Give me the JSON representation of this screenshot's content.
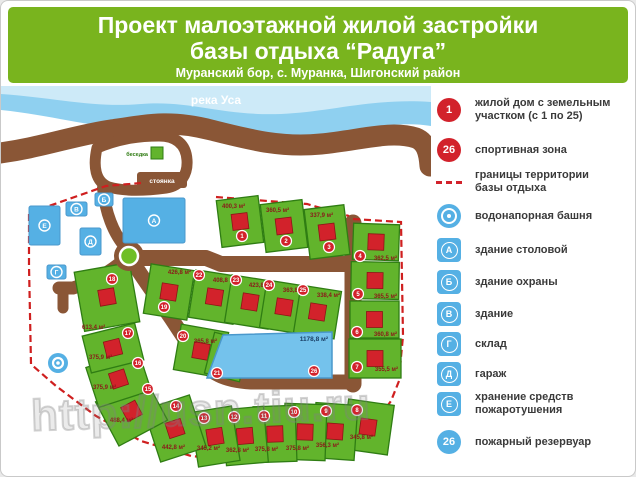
{
  "header": {
    "title_line1": "Проект малоэтажной жилой застройки",
    "title_line2": "базы отдыха “Радуга”",
    "subtitle": "Муранский бор, с. Муранка, Шигонский район"
  },
  "map": {
    "labels": {
      "river": "река Уса",
      "parking": "стоянка",
      "gazebo": "беседка"
    },
    "pond": {
      "area": "1178,8 м²",
      "badge": "26"
    },
    "plots": [
      {
        "n": "1",
        "area": "400,3 м²",
        "x": 218,
        "y": 112,
        "w": 42,
        "h": 47,
        "rot": -7,
        "bx": 241,
        "by": 150,
        "lx": 221,
        "ly": 122,
        "la": "start"
      },
      {
        "n": "2",
        "area": "360,5 м²",
        "x": 262,
        "y": 116,
        "w": 42,
        "h": 48,
        "rot": -7,
        "bx": 285,
        "by": 155,
        "lx": 265,
        "ly": 126,
        "la": "start"
      },
      {
        "n": "3",
        "area": "337,9 м²",
        "x": 306,
        "y": 121,
        "w": 40,
        "h": 50,
        "rot": -7,
        "bx": 328,
        "by": 161,
        "lx": 309,
        "ly": 131,
        "la": "start"
      },
      {
        "n": "4",
        "area": "362,5 м²",
        "x": 352,
        "y": 138,
        "w": 46,
        "h": 36,
        "rot": 2,
        "bx": 359,
        "by": 170,
        "lx": 396,
        "ly": 174,
        "la": "end"
      },
      {
        "n": "5",
        "area": "365,5 м²",
        "x": 350,
        "y": 176,
        "w": 48,
        "h": 37,
        "rot": 1,
        "bx": 357,
        "by": 208,
        "lx": 396,
        "ly": 212,
        "la": "end"
      },
      {
        "n": "6",
        "area": "360,8 м²",
        "x": 349,
        "y": 215,
        "w": 49,
        "h": 37,
        "rot": 0,
        "bx": 356,
        "by": 246,
        "lx": 396,
        "ly": 250,
        "la": "end"
      },
      {
        "n": "7",
        "area": "355,5 м²",
        "x": 348,
        "y": 253,
        "w": 52,
        "h": 39,
        "rot": 0,
        "bx": 356,
        "by": 281,
        "lx": 397,
        "ly": 285,
        "la": "end"
      },
      {
        "n": "8",
        "area": "345,8 м²",
        "x": 344,
        "y": 316,
        "w": 46,
        "h": 50,
        "rot": 8,
        "bx": 356,
        "by": 324,
        "lx": 372,
        "ly": 353,
        "la": "end"
      },
      {
        "n": "9",
        "area": "356,3 м²",
        "x": 313,
        "y": 318,
        "w": 42,
        "h": 55,
        "rot": 4,
        "bx": 325,
        "by": 325,
        "lx": 338,
        "ly": 361,
        "la": "end"
      },
      {
        "n": "10",
        "area": "375,8 м²",
        "x": 283,
        "y": 318,
        "w": 42,
        "h": 56,
        "rot": 2,
        "bx": 293,
        "by": 326,
        "lx": 308,
        "ly": 364,
        "la": "end"
      },
      {
        "n": "11",
        "area": "375,8 м²",
        "x": 253,
        "y": 320,
        "w": 42,
        "h": 56,
        "rot": -2,
        "bx": 263,
        "by": 330,
        "lx": 277,
        "ly": 365,
        "la": "end"
      },
      {
        "n": "12",
        "area": "362,8 м²",
        "x": 223,
        "y": 322,
        "w": 42,
        "h": 56,
        "rot": -5,
        "bx": 233,
        "by": 331,
        "lx": 248,
        "ly": 366,
        "la": "end"
      },
      {
        "n": "13",
        "area": "345,2 м²",
        "x": 193,
        "y": 323,
        "w": 42,
        "h": 55,
        "rot": -9,
        "bx": 203,
        "by": 332,
        "lx": 219,
        "ly": 364,
        "la": "end"
      },
      {
        "n": "14",
        "area": "442,8 м²",
        "x": 150,
        "y": 315,
        "w": 48,
        "h": 55,
        "rot": -18,
        "bx": 175,
        "by": 320,
        "lx": 184,
        "ly": 363,
        "la": "end"
      },
      {
        "n": "15",
        "area": "488,4 м²",
        "x": 103,
        "y": 300,
        "w": 55,
        "h": 50,
        "rot": -28,
        "bx": 147,
        "by": 303,
        "lx": 132,
        "ly": 336,
        "la": "end"
      },
      {
        "n": "16",
        "area": "375,9 м²",
        "x": 90,
        "y": 272,
        "w": 55,
        "h": 42,
        "rot": -18,
        "bx": 137,
        "by": 277,
        "lx": 92,
        "ly": 303,
        "la": "start"
      },
      {
        "n": "17",
        "area": "375,9 м²",
        "x": 85,
        "y": 243,
        "w": 54,
        "h": 38,
        "rot": -14,
        "bx": 127,
        "by": 247,
        "lx": 88,
        "ly": 273,
        "la": "start"
      },
      {
        "n": "18",
        "area": "613,4 м²",
        "x": 78,
        "y": 181,
        "w": 56,
        "h": 60,
        "rot": -10,
        "bx": 111,
        "by": 193,
        "lx": 81,
        "ly": 243,
        "la": "start"
      },
      {
        "n": "19",
        "area": "426,8 м²",
        "x": 146,
        "y": 181,
        "w": 44,
        "h": 50,
        "rot": 9,
        "bx": 163,
        "by": 221,
        "lx": 190,
        "ly": 188,
        "la": "end"
      },
      {
        "n": "20",
        "area": "365,8 м²",
        "x": 176,
        "y": 242,
        "w": 48,
        "h": 46,
        "rot": 10,
        "bx": 182,
        "by": 250,
        "lx": 216,
        "ly": 257,
        "la": "end"
      },
      {
        "n": "21",
        "area": "",
        "x": 208,
        "y": 250,
        "w": 36,
        "h": 42,
        "rot": 14,
        "bx": 216,
        "by": 287,
        "lx": 0,
        "ly": 0,
        "la": "start",
        "house": false
      },
      {
        "n": "22",
        "area": "408,8 м²",
        "x": 191,
        "y": 187,
        "w": 45,
        "h": 48,
        "rot": 9,
        "bx": 198,
        "by": 189,
        "lx": 235,
        "ly": 196,
        "la": "end"
      },
      {
        "n": "23",
        "area": "423,8 м²",
        "x": 227,
        "y": 192,
        "w": 44,
        "h": 48,
        "rot": 9,
        "bx": 235,
        "by": 194,
        "lx": 271,
        "ly": 201,
        "la": "end"
      },
      {
        "n": "24",
        "area": "363,8 м²",
        "x": 262,
        "y": 197,
        "w": 42,
        "h": 48,
        "rot": 9,
        "bx": 268,
        "by": 199,
        "lx": 305,
        "ly": 206,
        "la": "end"
      },
      {
        "n": "25",
        "area": "338,4 м²",
        "x": 296,
        "y": 202,
        "w": 41,
        "h": 48,
        "rot": 9,
        "bx": 302,
        "by": 204,
        "lx": 339,
        "ly": 211,
        "la": "end"
      }
    ],
    "buildings": [
      {
        "letter": "А",
        "x": 122,
        "y": 112,
        "w": 62,
        "h": 45
      },
      {
        "letter": "Б",
        "x": 94,
        "y": 107,
        "w": 18,
        "h": 13
      },
      {
        "letter": "В",
        "x": 65,
        "y": 116,
        "w": 21,
        "h": 14
      },
      {
        "letter": "Е",
        "x": 28,
        "y": 120,
        "w": 31,
        "h": 39
      },
      {
        "letter": "Д",
        "x": 79,
        "y": 142,
        "w": 21,
        "h": 27
      },
      {
        "letter": "Г",
        "x": 46,
        "y": 179,
        "w": 19,
        "h": 14
      }
    ]
  },
  "legend": {
    "items": [
      {
        "symbol": "1",
        "type": "red-circle",
        "label": "жилой дом с земельным\nучастком (с 1 по 25)"
      },
      {
        "symbol": "26",
        "type": "red-circle",
        "label": "спортивная зона"
      },
      {
        "symbol": "",
        "type": "dashed",
        "label": "границы территории\nбазы отдыха"
      },
      {
        "symbol": "",
        "type": "tower",
        "label": "водонапорная башня"
      },
      {
        "symbol": "А",
        "type": "blue-square",
        "label": "здание столовой"
      },
      {
        "symbol": "Б",
        "type": "blue-square",
        "label": "здание охраны"
      },
      {
        "symbol": "В",
        "type": "blue-square",
        "label": "здание"
      },
      {
        "symbol": "Г",
        "type": "blue-square",
        "label": "склад"
      },
      {
        "symbol": "Д",
        "type": "blue-square",
        "label": "гараж"
      },
      {
        "symbol": "Е",
        "type": "blue-square",
        "label": "хранение средств\nпожаротушения"
      },
      {
        "symbol": "26",
        "type": "blue-circle",
        "label": "пожарный резервуар"
      }
    ]
  },
  "watermark": "http://usn.tiu.ru",
  "colors": {
    "header_green": "#79b41e",
    "road_brown": "#8a5636",
    "plot_green": "#62b42c",
    "plot_border": "#2f7d13",
    "house_red": "#d2222b",
    "water_blue": "#74c2ec",
    "river_light": "#cdeaf8",
    "river_mid": "#8fd0f0",
    "legend_blue": "#55b0e4",
    "boundary_red": "#cf1f1f",
    "roundabout_green": "#6fbe26"
  }
}
